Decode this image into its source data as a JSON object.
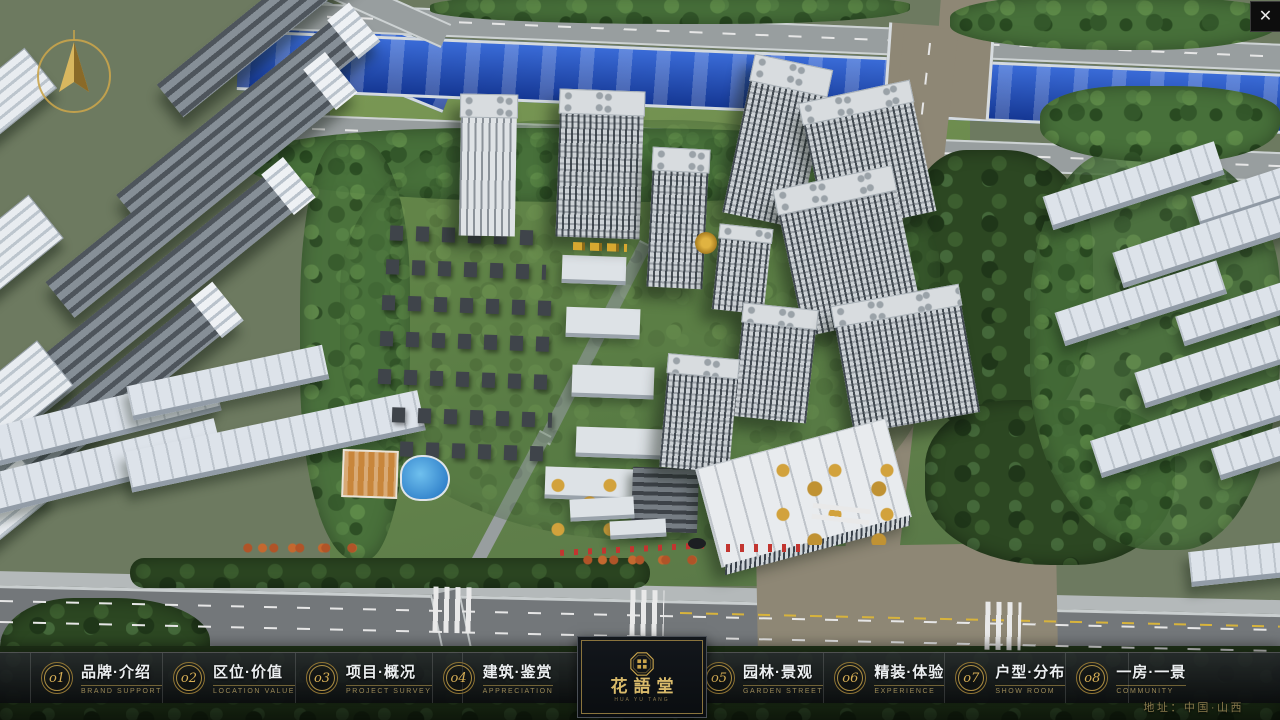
{
  "ui": {
    "close_icon": "✕",
    "address": "地址：中国·山西"
  },
  "logo": {
    "title_zh": "花語堂",
    "caption": "HUA YU TANG"
  },
  "menu": {
    "items": [
      {
        "num": "o1",
        "zh": "品牌·介绍",
        "en": "BRAND SUPPORT"
      },
      {
        "num": "o2",
        "zh": "区位·价值",
        "en": "LOCATION VALUE"
      },
      {
        "num": "o3",
        "zh": "项目·概况",
        "en": "PROJECT SURVEY"
      },
      {
        "num": "o4",
        "zh": "建筑·鉴赏",
        "en": "APPRECIATION"
      },
      {
        "num": "o5",
        "zh": "园林·景观",
        "en": "GARDEN STREET"
      },
      {
        "num": "o6",
        "zh": "精装·体验",
        "en": "EXPERIENCE"
      },
      {
        "num": "o7",
        "zh": "户型·分布",
        "en": "SHOW ROOM"
      },
      {
        "num": "o8",
        "zh": "一房·一景",
        "en": "COMMUNITY"
      }
    ]
  },
  "colors": {
    "gold": "#c9a44b",
    "gold_text": "#d6ae55",
    "river_blue": "#1e4fc2",
    "bar_bg": "rgba(18,20,23,0.85)"
  }
}
